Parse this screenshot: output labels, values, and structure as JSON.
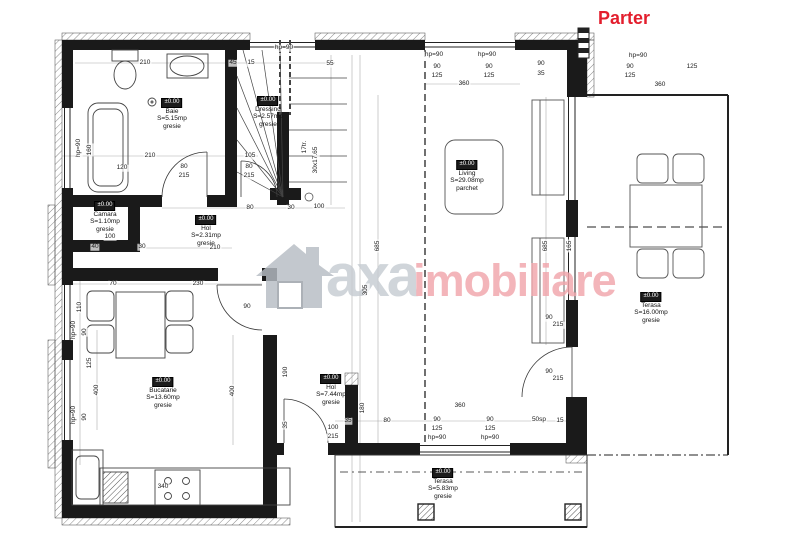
{
  "title": {
    "text": "Parter",
    "color": "#e31e2d"
  },
  "watermark": {
    "brand_first": "axa",
    "brand_second": "imobiliare",
    "icon": "house-logo",
    "color_first": "#c6ccd2",
    "color_second": "#f1a6ac"
  },
  "rooms": [
    {
      "id": "baie",
      "level": "±0.00",
      "name": "Baie",
      "area": "S=5.15mp",
      "finish": "gresie"
    },
    {
      "id": "dressing",
      "level": "±0.00",
      "name": "Dressing",
      "area": "S=2.57mp",
      "finish": "gresie"
    },
    {
      "id": "living",
      "level": "±0.00",
      "name": "Living",
      "area": "S=29.08mp",
      "finish": "parchet"
    },
    {
      "id": "camara",
      "level": "±0.00",
      "name": "Camara",
      "area": "S=1.10mp",
      "finish": "gresie"
    },
    {
      "id": "hol-mic",
      "level": "±0.00",
      "name": "Hol",
      "area": "S=2.31mp",
      "finish": "gresie"
    },
    {
      "id": "bucatarie",
      "level": "±0.00",
      "name": "Bucatarie",
      "area": "S=13.60mp",
      "finish": "gresie"
    },
    {
      "id": "hol",
      "level": "±0.00",
      "name": "Hol",
      "area": "S=7.44mp",
      "finish": "gresie"
    },
    {
      "id": "terasa-est",
      "level": "±0.00",
      "name": "Terasa",
      "area": "S=16.00mp",
      "finish": "gresie"
    },
    {
      "id": "terasa-sud",
      "level": "±0.00",
      "name": "Terasa",
      "area": "S=5.83mp",
      "finish": "gresie"
    }
  ],
  "stairs": {
    "treads": "17tr.",
    "step_size": "30x17.65"
  },
  "dimensions": [
    {
      "t": "210",
      "x": 145,
      "y": 63
    },
    {
      "t": "45",
      "x": 233,
      "y": 63
    },
    {
      "t": "15",
      "x": 251,
      "y": 63
    },
    {
      "t": "hp=90",
      "x": 284,
      "y": 48
    },
    {
      "t": "55",
      "x": 330,
      "y": 64
    },
    {
      "t": "hp=90",
      "x": 434,
      "y": 55
    },
    {
      "t": "hp=90",
      "x": 487,
      "y": 55
    },
    {
      "t": "90",
      "x": 437,
      "y": 67
    },
    {
      "t": "125",
      "x": 437,
      "y": 76
    },
    {
      "t": "360",
      "x": 464,
      "y": 84
    },
    {
      "t": "90",
      "x": 489,
      "y": 67
    },
    {
      "t": "125",
      "x": 489,
      "y": 76
    },
    {
      "t": "90",
      "x": 541,
      "y": 64
    },
    {
      "t": "35",
      "x": 541,
      "y": 74
    },
    {
      "t": "hp=90",
      "x": 79,
      "y": 148,
      "r": 1
    },
    {
      "t": "160",
      "x": 90,
      "y": 150,
      "r": 1
    },
    {
      "t": "120",
      "x": 122,
      "y": 168
    },
    {
      "t": "210",
      "x": 150,
      "y": 156
    },
    {
      "t": "105",
      "x": 250,
      "y": 156
    },
    {
      "t": "80",
      "x": 184,
      "y": 167
    },
    {
      "t": "215",
      "x": 184,
      "y": 176
    },
    {
      "t": "80",
      "x": 249,
      "y": 167
    },
    {
      "t": "215",
      "x": 249,
      "y": 176
    },
    {
      "t": "17tr.",
      "x": 305,
      "y": 147,
      "r": 1
    },
    {
      "t": "30x17.65",
      "x": 316,
      "y": 160,
      "r": 1
    },
    {
      "t": "305",
      "x": 366,
      "y": 290,
      "r": 1
    },
    {
      "t": "685",
      "x": 378,
      "y": 246,
      "r": 1
    },
    {
      "t": "685",
      "x": 546,
      "y": 246,
      "r": 1
    },
    {
      "t": "165",
      "x": 570,
      "y": 246,
      "r": 1
    },
    {
      "t": "90",
      "x": 549,
      "y": 318
    },
    {
      "t": "215",
      "x": 558,
      "y": 325
    },
    {
      "t": "90",
      "x": 549,
      "y": 372
    },
    {
      "t": "215",
      "x": 558,
      "y": 379
    },
    {
      "t": "hp=90",
      "x": 638,
      "y": 56
    },
    {
      "t": "90",
      "x": 630,
      "y": 67
    },
    {
      "t": "125",
      "x": 630,
      "y": 76
    },
    {
      "t": "360",
      "x": 660,
      "y": 85
    },
    {
      "t": "125",
      "x": 692,
      "y": 67
    },
    {
      "t": "80",
      "x": 250,
      "y": 208
    },
    {
      "t": "30",
      "x": 291,
      "y": 208
    },
    {
      "t": "100",
      "x": 319,
      "y": 207
    },
    {
      "t": "40",
      "x": 95,
      "y": 247
    },
    {
      "t": "30",
      "x": 142,
      "y": 247
    },
    {
      "t": "210",
      "x": 215,
      "y": 248
    },
    {
      "t": "100",
      "x": 110,
      "y": 237
    },
    {
      "t": "110",
      "x": 80,
      "y": 307,
      "r": 1
    },
    {
      "t": "hp=90",
      "x": 74,
      "y": 330,
      "r": 1
    },
    {
      "t": "90",
      "x": 85,
      "y": 332,
      "r": 1
    },
    {
      "t": "125",
      "x": 90,
      "y": 363,
      "r": 1
    },
    {
      "t": "400",
      "x": 97,
      "y": 390,
      "r": 1
    },
    {
      "t": "hp=90",
      "x": 74,
      "y": 415,
      "r": 1
    },
    {
      "t": "90",
      "x": 85,
      "y": 417,
      "r": 1
    },
    {
      "t": "70",
      "x": 113,
      "y": 284
    },
    {
      "t": "230",
      "x": 198,
      "y": 284
    },
    {
      "t": "90",
      "x": 247,
      "y": 307
    },
    {
      "t": "400",
      "x": 233,
      "y": 391,
      "r": 1
    },
    {
      "t": "190",
      "x": 286,
      "y": 372,
      "r": 1
    },
    {
      "t": "35",
      "x": 286,
      "y": 425,
      "r": 1
    },
    {
      "t": "340",
      "x": 163,
      "y": 487
    },
    {
      "t": "180",
      "x": 363,
      "y": 408,
      "r": 1
    },
    {
      "t": "360",
      "x": 460,
      "y": 406
    },
    {
      "t": "90",
      "x": 437,
      "y": 420
    },
    {
      "t": "125",
      "x": 437,
      "y": 429
    },
    {
      "t": "hp=90",
      "x": 437,
      "y": 438
    },
    {
      "t": "90",
      "x": 490,
      "y": 420
    },
    {
      "t": "125",
      "x": 490,
      "y": 429
    },
    {
      "t": "hp=90",
      "x": 490,
      "y": 438
    },
    {
      "t": "50sp",
      "x": 539,
      "y": 420
    },
    {
      "t": "15",
      "x": 560,
      "y": 421
    },
    {
      "t": "35",
      "x": 348,
      "y": 421
    },
    {
      "t": "80",
      "x": 387,
      "y": 421
    },
    {
      "t": "100",
      "x": 333,
      "y": 428
    },
    {
      "t": "215",
      "x": 333,
      "y": 437
    }
  ]
}
